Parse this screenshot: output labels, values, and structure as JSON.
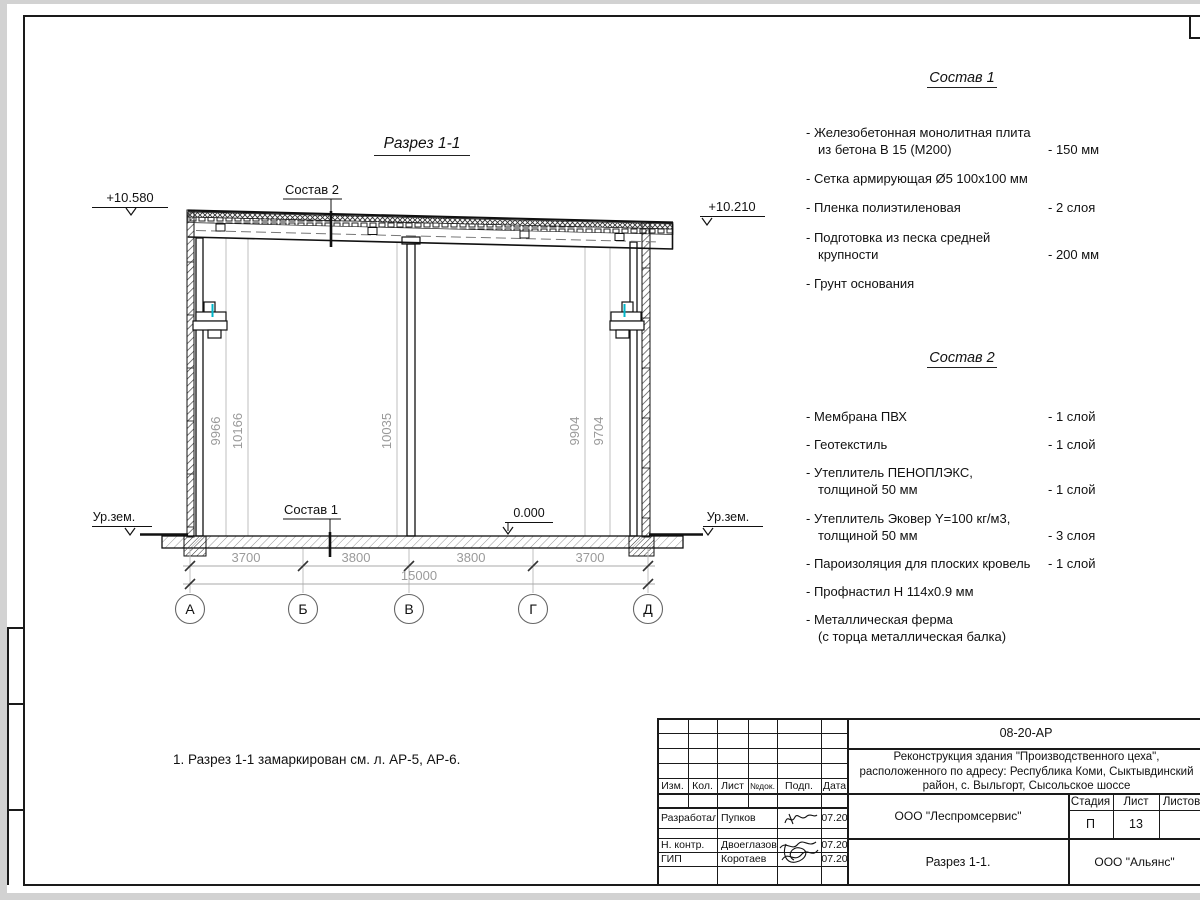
{
  "page": {
    "drawing_title": "Разрез 1-1",
    "note": "1. Разрез 1-1 замаркирован см. л. АР-5, АР-6."
  },
  "section": {
    "leader_top": "Состав 2",
    "leader_bottom": "Состав 1",
    "elevations": {
      "top_left": "+10.580",
      "top_right": "+10.210",
      "ground_left": "Ур.зем.",
      "ground_right": "Ур.зем.",
      "floor": "0.000"
    },
    "vertical_dims": [
      "9966",
      "10166",
      "10035",
      "9904",
      "9704"
    ],
    "bottom_dims": [
      "3700",
      "3800",
      "3800",
      "3700"
    ],
    "total_dim": "15000",
    "axes": [
      "А",
      "Б",
      "В",
      "Г",
      "Д"
    ]
  },
  "composition1": {
    "title": "Состав 1",
    "items": [
      {
        "name": "- Железобетонная  монолитная плита\nиз бетона В 15 (М200)",
        "value": "- 150 мм"
      },
      {
        "name": "- Сетка армирующая Ø5 100х100 мм",
        "value": ""
      },
      {
        "name": "- Пленка полиэтиленовая",
        "value": "-  2 слоя"
      },
      {
        "name": "- Подготовка из песка средней\nкрупности",
        "value": "- 200 мм"
      },
      {
        "name": "- Грунт основания",
        "value": ""
      }
    ]
  },
  "composition2": {
    "title": "Состав 2",
    "items": [
      {
        "name": "- Мембрана ПВХ",
        "value": "- 1 слой"
      },
      {
        "name": "- Геотекстиль",
        "value": "- 1 слой"
      },
      {
        "name": "- Утеплитель ПЕНОПЛЭКС,\nтолщиной 50 мм",
        "value": "- 1 слой"
      },
      {
        "name": "- Утеплитель Эковер Y=100 кг/м3,\nтолщиной 50 мм",
        "value": "- 3 слоя"
      },
      {
        "name": "- Пароизоляция для плоских кровель",
        "value": "- 1 слой"
      },
      {
        "name": "- Профнастил Н 114х0.9 мм",
        "value": ""
      },
      {
        "name": "- Металлическая ферма\n(с торца металлическая балка)",
        "value": ""
      }
    ]
  },
  "titleblock": {
    "doc_number": "08-20-АР",
    "project_line1": "Реконструкция здания \"Производственного цеха\",",
    "project_line2": "расположенного по адресу: Республика Коми, Сыктывдинский",
    "project_line3": "район, с. Выльгорт, Сысольское шоссе",
    "org": "ООО \"Леспромсервис\"",
    "sheet_title": "Разрез 1-1.",
    "contractor": "ООО \"Альянс\"",
    "stage_label": "Стадия",
    "sheet_label": "Лист",
    "sheets_label": "Листов",
    "stage_value": "П",
    "sheet_value": "13",
    "header": {
      "izm": "Изм.",
      "kol": "Кол.",
      "list": "Лист",
      "ndoc": "№док.",
      "podp": "Подп.",
      "data": "Дата"
    },
    "rows": [
      {
        "role": "Разработал",
        "name": "Пупков",
        "date": "07.20"
      },
      {
        "role": "Н. контр.",
        "name": "Двоеглазов",
        "date": "07.20"
      },
      {
        "role": "ГИП",
        "name": "Коротаев",
        "date": "07.20"
      }
    ]
  },
  "colors": {
    "accent_cyan": "#00b5c8",
    "dim_gray": "#9a9a9a",
    "ink": "#1a1a1a"
  }
}
